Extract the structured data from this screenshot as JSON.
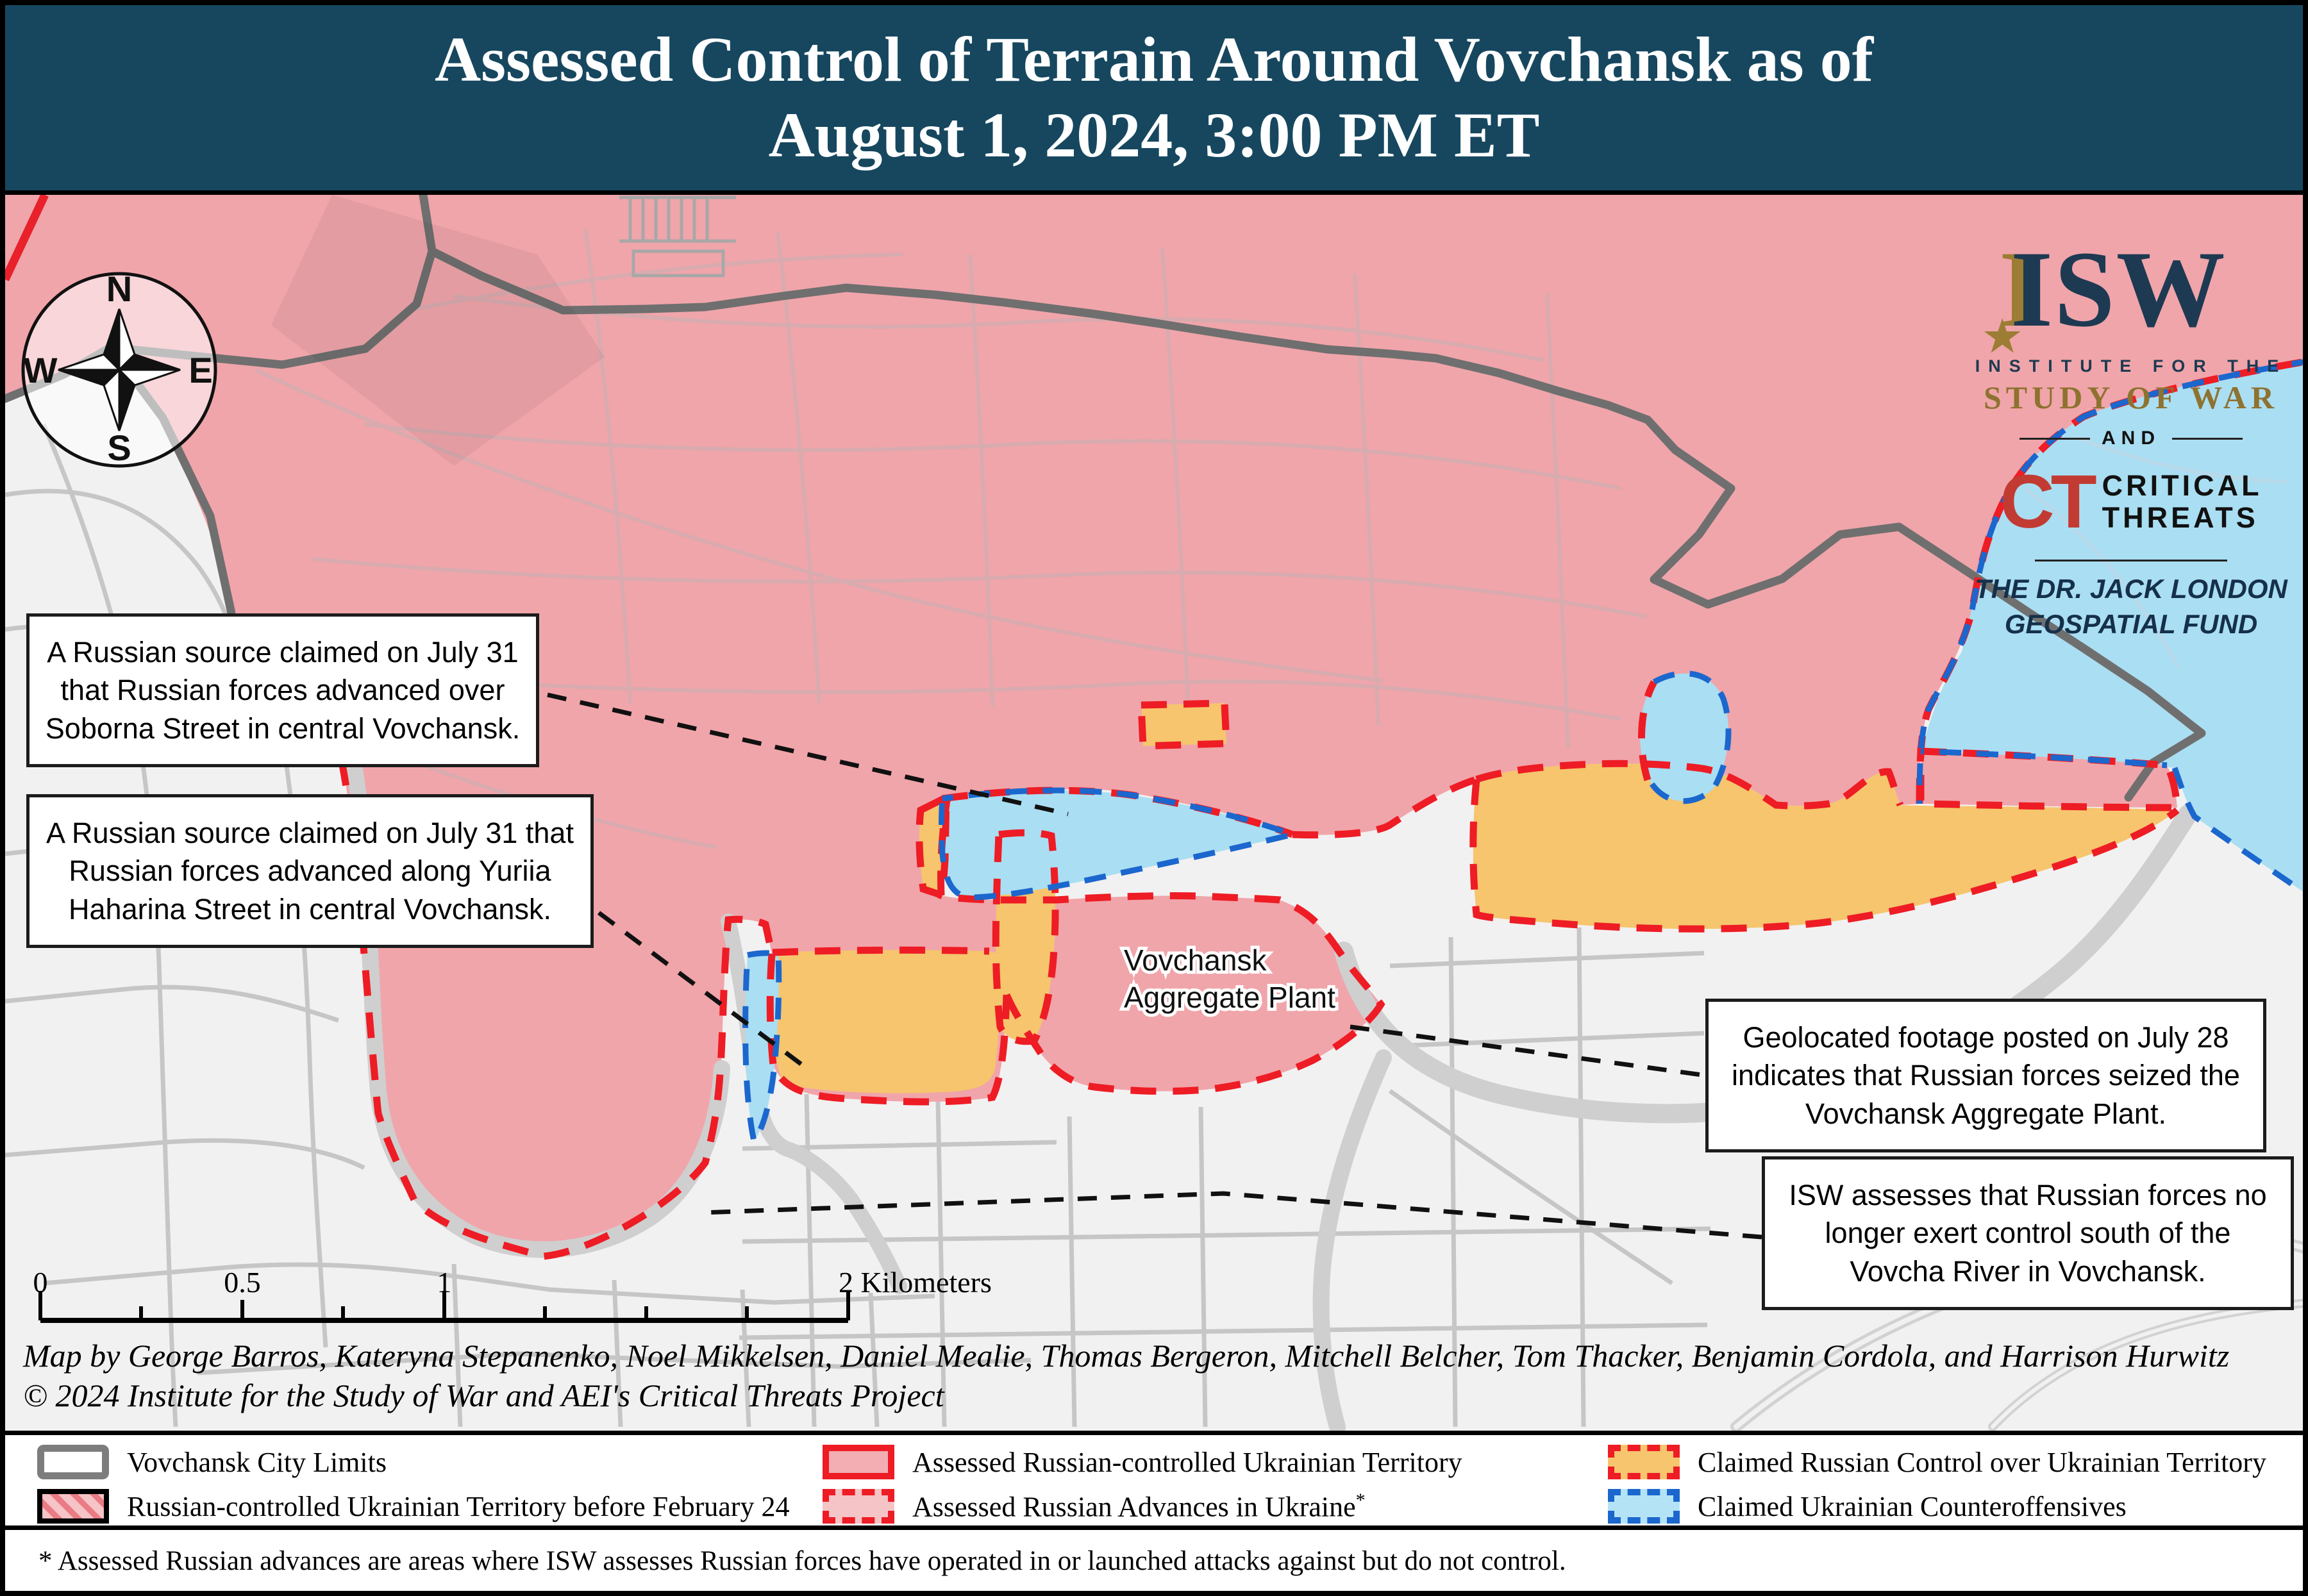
{
  "header": {
    "line1": "Assessed Control of Terrain Around Vovchansk as of",
    "line2": "August 1, 2024, 3:00 PM ET"
  },
  "logo": {
    "isw": "ISW",
    "gold_i": "I",
    "star": "★",
    "institute": "INSTITUTE FOR THE",
    "study": "STUDY OF WAR",
    "and": "AND",
    "ct": "CT",
    "critical_line1": "CRITICAL",
    "critical_line2": "THREATS",
    "fund_line1": "THE DR. JACK LONDON",
    "fund_line2": "GEOSPATIAL FUND"
  },
  "compass": {
    "n": "N",
    "e": "E",
    "s": "S",
    "w": "W"
  },
  "annotations": [
    {
      "text": "A Russian source claimed on July 31 that Russian forces advanced over Soborna Street in central Vovchansk."
    },
    {
      "text": "A Russian source claimed on July 31 that Russian forces advanced along Yuriia Haharina Street in central Vovchansk."
    },
    {
      "text": "Geolocated footage posted on July 28 indicates that Russian forces seized the Vovchansk Aggregate Plant."
    },
    {
      "text": "ISW assesses that Russian forces no longer exert control south of the Vovcha River in Vovchansk."
    }
  ],
  "map_labels": {
    "plant_line1": "Vovchansk",
    "plant_line2": "Aggregate Plant"
  },
  "scale": {
    "k0": "0",
    "k05": "0.5",
    "k1": "1",
    "k2": "2 Kilometers"
  },
  "credits": {
    "line1": "Map by George Barros, Kateryna Stepanenko, Noel Mikkelsen, Daniel Mealie, Thomas Bergeron, Mitchell Belcher, Tom Thacker, Benjamin Cordola, and Harrison Hurwitz",
    "line2": "© 2024 Institute for the Study of War and AEI's Critical Threats Project"
  },
  "legend": {
    "items": [
      {
        "label": "Vovchansk City Limits"
      },
      {
        "label": "Russian-controlled Ukrainian Territory before February 24"
      },
      {
        "label": "Assessed Russian-controlled Ukrainian Territory"
      },
      {
        "label": "Assessed Russian Advances in Ukraine",
        "sup": "*"
      },
      {
        "label": "Claimed Russian Control over Ukrainian Territory"
      },
      {
        "label": "Claimed Ukrainian Counteroffensives"
      }
    ]
  },
  "footnote": {
    "text": "* Assessed Russian advances are areas where ISW assesses Russian forces have operated in or launched attacks against but do not control."
  },
  "colors": {
    "header_bg": "#16475f",
    "russian_controlled_fill": "#f0a5aa",
    "claimed_russian_fill": "#f6c56d",
    "claimed_ukrainian_fill": "#aadef2",
    "assessed_advance_border": "#ee1c25",
    "ukrainian_border": "#1b67ce",
    "city_limits_gray": "#6f6f6f",
    "isw_navy": "#1d3a52",
    "isw_gold": "#9c7d33",
    "ct_red": "#c23b33"
  }
}
